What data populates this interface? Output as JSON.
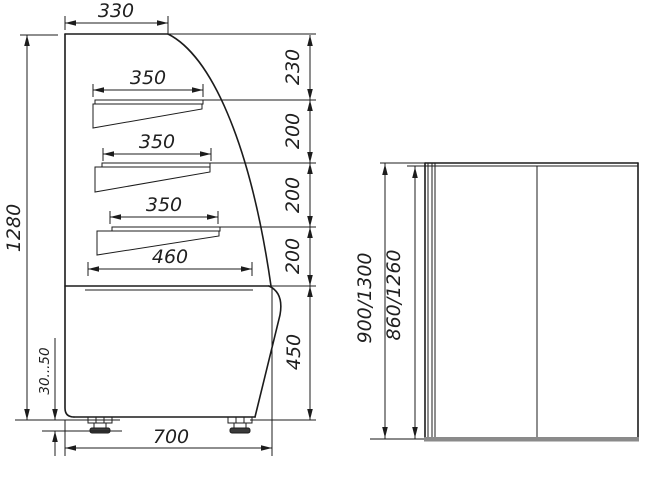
{
  "drawing": {
    "front_view": {
      "top_depth": "330",
      "shelf1_depth": "350",
      "shelf2_depth": "350",
      "shelf3_depth": "350",
      "deck_depth": "460",
      "total_height": "1280",
      "seg_top": "230",
      "seg_2": "200",
      "seg_3": "200",
      "seg_4": "200",
      "base_height": "450",
      "base_depth": "700",
      "leg_adjust": "30...50"
    },
    "side_view": {
      "overall_height": "900/1300",
      "inner_height": "860/1260"
    },
    "colors": {
      "line": "#1c1c1c",
      "plinth_gray": "#8a8a8a",
      "foot_pad": "#3a3a3a"
    }
  }
}
